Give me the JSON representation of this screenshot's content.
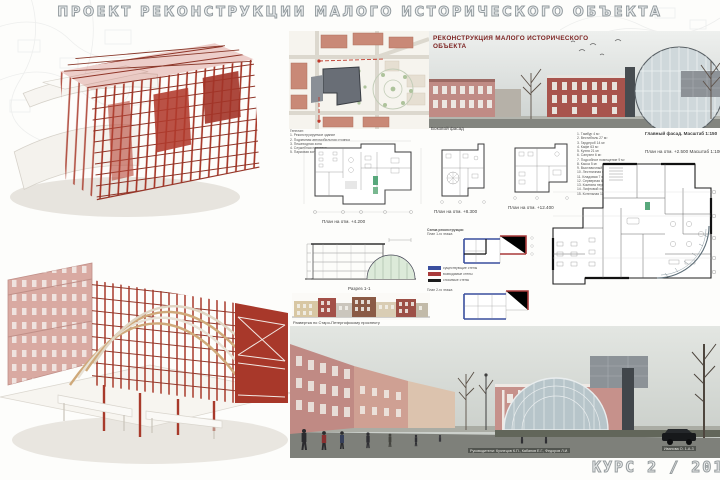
{
  "board": {
    "title": "ПРОЕКТ РЕКОНСТРУКЦИИ МАЛОГО ИСТОРИЧЕСКОГО ОБЪЕКТА",
    "course": "КУРС 2 / 2017"
  },
  "top_render": {
    "heading_line1": "РЕКОНСТРУКЦИЯ МАЛОГО ИСТОРИЧЕСКОГО",
    "heading_line2": "ОБЪЕКТА",
    "caption_side_facade": "Боковой фасад",
    "caption_main_facade": "Главный фасад. Масштаб 1:150"
  },
  "genplan": {
    "legend_title": "Генплан:",
    "legend_items": [
      "1. Реконструируемое здание",
      "2. Подземная автомобильная стоянка",
      "3. Пешеходная зона",
      "4. Служебная парковка",
      "5. Парковая зона"
    ]
  },
  "plans": {
    "caption_plan_4200": "План на отм. +4.200",
    "caption_plan_8300": "План на отм. +8.300",
    "caption_plan_12400": "План на отм. +12.400",
    "caption_plan_2500": "План на отм. +2.500 Масштаб 1:100",
    "caption_section": "Разрез 1-1",
    "caption_elevation_strip": "Развертка по Старо-Петергофскому проспекту",
    "room_list": [
      "1. Тамбур 4 м²",
      "2. Вестибюль 27 м²",
      "3. Гардероб 14 м²",
      "4. Кафе 63 м²",
      "5. Кухня 21 м²",
      "6. Санузел 6 м²",
      "7. Подсобное помещение 9 м²",
      "8. Касса 5 м²",
      "9. Выставочный зал 87 м²",
      "10. Лестничная клетка 16 м²",
      "11. Кладовая 7 м²",
      "12. Серверная 6 м²",
      "13. Комната персонала 12 м²",
      "14. Лифтовой холл 8 м²",
      "15. Котельная 11 м²"
    ]
  },
  "scheme": {
    "title": "Схема реконструкции",
    "floor1_label": "План 1-го этажа",
    "floor2_label": "План 2-го этажа",
    "legend": [
      {
        "label": "существующие стены",
        "color": "#3a4f9e"
      },
      {
        "label": "возводимые стены",
        "color": "#a93a3a"
      },
      {
        "label": "сносимые стены",
        "color": "#1c1c1c"
      }
    ]
  },
  "bottom_render": {
    "credits_left": "Руководители: Кузнецов К.П., Кабанов Е.Г., Федоров Л.И.",
    "credits_right": "Иванова О. 1-А-3"
  },
  "colors": {
    "accent_red": "#a93226",
    "header_text_red": "#7c2322",
    "model_frame_red": "#a83a2b",
    "legend_existing": "#3a4f9e",
    "legend_new": "#a93a3a",
    "legend_demolish": "#1c1c1c"
  }
}
